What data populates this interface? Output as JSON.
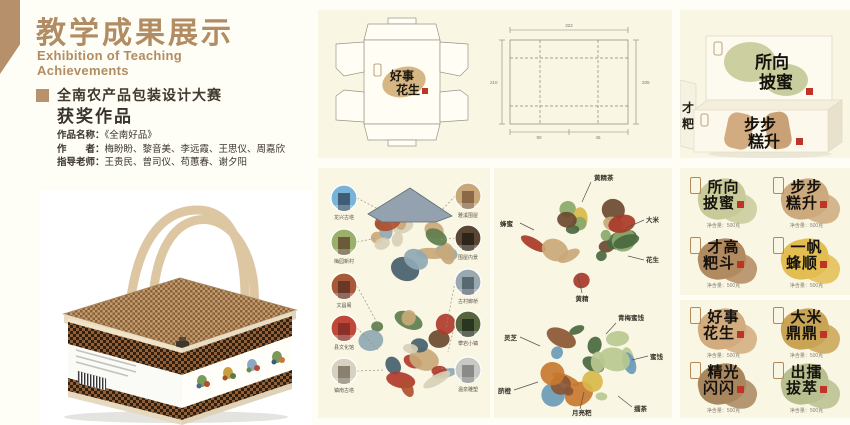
{
  "accent_color": "#b28c62",
  "seal_red": "#c03428",
  "header": {
    "title": "教学成果展示",
    "subtitle_en_line1": "Exhibition of Teaching",
    "subtitle_en_line2": "Achievements",
    "competition": "全南农产品包装设计大赛",
    "award": "获奖作品"
  },
  "work_info": {
    "name_label": "作品名称：",
    "name_value": "《全南好品》",
    "authors_label": "作　　者：",
    "authors_value": "梅盼盼、黎音美、李远霞、王思仪、周嘉欣",
    "teachers_label": "指导老师：",
    "teachers_value": "王贵民、曾司仪、苟蕙春、谢夕阳"
  },
  "dieline_panel": {
    "design_l1": "好事",
    "design_l2": "花生",
    "dim_top": "322",
    "dim_left": "210",
    "dim_right": "205",
    "dim_bottom_1": "90",
    "dim_bottom_2": "45"
  },
  "boxes_panel": {
    "back_l1": "所向",
    "back_l2": "披蜜",
    "front_l1": "步步",
    "front_l2": "糕升",
    "partial_l1": "才",
    "partial_l2": "粑",
    "net_weight": "净含量：500克"
  },
  "map_panel": {
    "left_labels": [
      "龙兴古塔",
      "梅园新村",
      "文昌阁",
      "县文化馆",
      "镇南古塔"
    ],
    "right_labels": [
      "雅溪围屋",
      "围屋内景",
      "古村廊桥",
      "攀岩小镇",
      "温泉雕塑"
    ]
  },
  "food_panel": {
    "top_labels": [
      "黄精茶",
      "蜂蜜",
      "大米",
      "花生",
      "黄精"
    ],
    "bottom_labels": [
      "青梅蜜饯",
      "灵芝",
      "蜜饯",
      "脐橙",
      "月亮粑",
      "擂茶"
    ]
  },
  "logos": [
    {
      "l1": "所向",
      "l2": "披蜜",
      "color": "#c8ca9a",
      "sub": "净含量：500克"
    },
    {
      "l1": "步步",
      "l2": "糕升",
      "color": "#cdaa7e",
      "sub": "净含量：500克"
    },
    {
      "l1": "才高",
      "l2": "粑斗",
      "color": "#b28a60",
      "sub": "净含量：500克"
    },
    {
      "l1": "一帆",
      "l2": "蜂顺",
      "color": "#e3bd52",
      "sub": "净含量：500克"
    },
    {
      "l1": "好事",
      "l2": "花生",
      "color": "#d2ac7e",
      "sub": "净含量：500克"
    },
    {
      "l1": "大米",
      "l2": "鼎鼎",
      "color": "#c9a455",
      "sub": "净含量：500克"
    },
    {
      "l1": "精光",
      "l2": "闪闪",
      "color": "#a8875f",
      "sub": "净含量：500克"
    },
    {
      "l1": "出擂",
      "l2": "拔萃",
      "color": "#b7bf8e",
      "sub": "净含量：500克"
    }
  ]
}
